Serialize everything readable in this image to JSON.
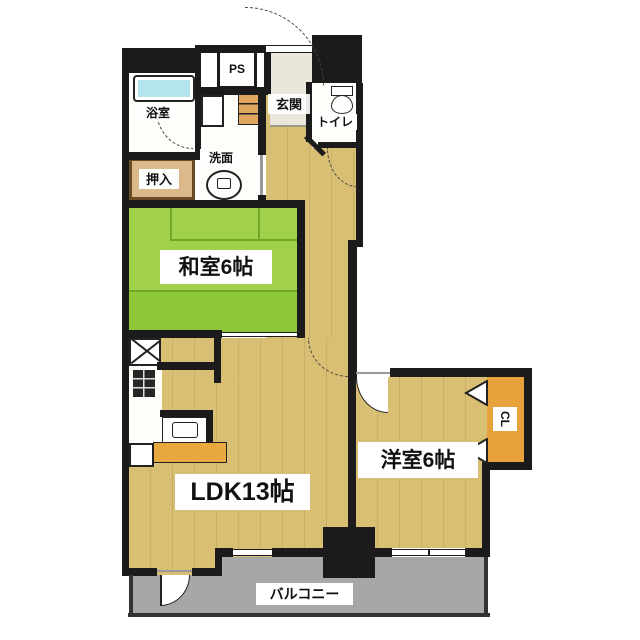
{
  "floorplan": {
    "title": "apartment-floor-plan-1LDK+2",
    "rooms": {
      "washitsu": {
        "label": "和室6帖"
      },
      "ldk": {
        "label": "LDK13帖"
      },
      "yoshitsu": {
        "label": "洋室6帖"
      },
      "balcony": {
        "label": "バルコニー"
      },
      "genkan": {
        "label": "玄関"
      },
      "toilet": {
        "label": "トイレ"
      },
      "washroom": {
        "label": "洗面"
      },
      "bathroom": {
        "label": "浴室"
      },
      "oshiire": {
        "label": "押入"
      },
      "pipe_space": {
        "label": "PS"
      },
      "closet": {
        "label": "CL"
      }
    },
    "colors": {
      "wall": "#1b1b1b",
      "tatami_green": "#a1d14a",
      "tatami_green_dark": "#8fc73a",
      "floor_tan": "#d9bf74",
      "genkan_floor": "#eae6d9",
      "closet_orange": "#e7a23c",
      "oshiire_tan": "#dcb98a",
      "balcony_gray": "#a7a7a7",
      "bathtub_blue": "#b4e4ec",
      "label_bg": "#ffffff"
    }
  }
}
